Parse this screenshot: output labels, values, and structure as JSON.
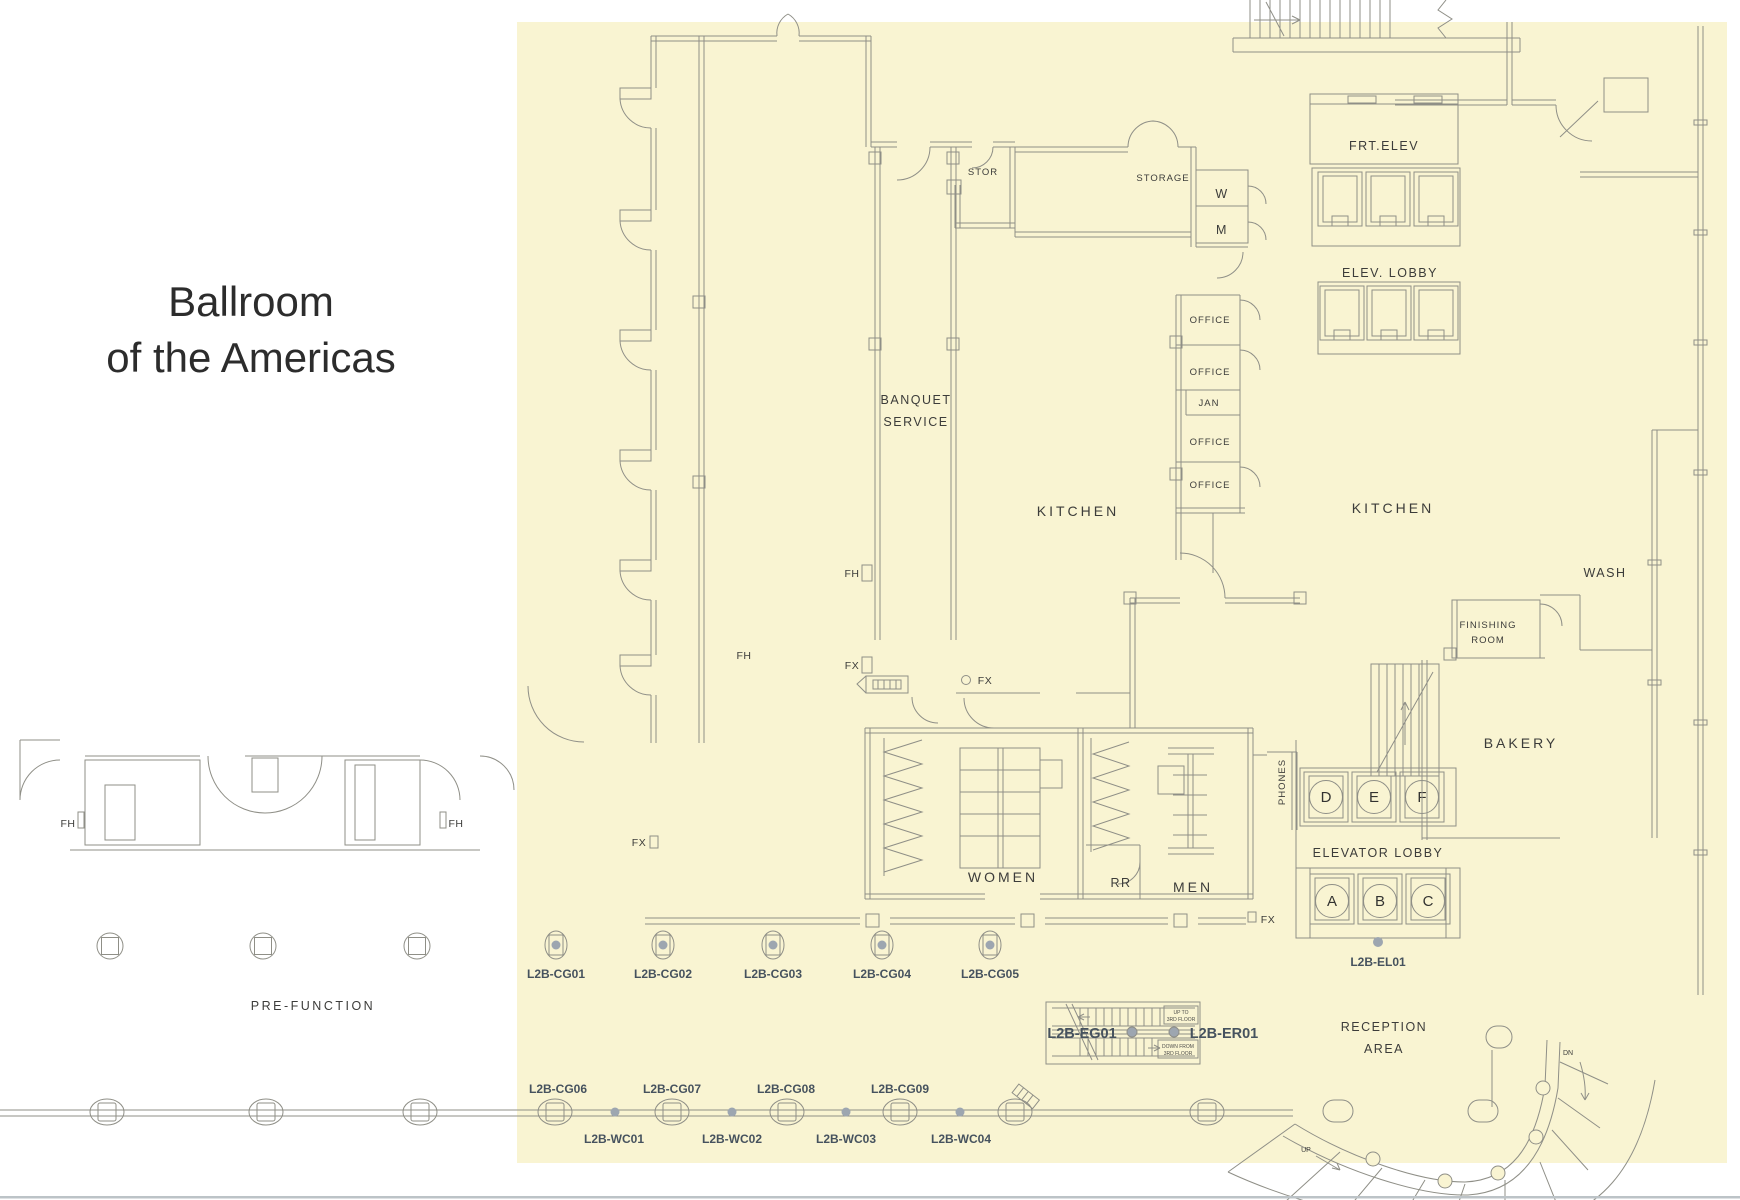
{
  "title": {
    "line1": "Ballroom",
    "line2": "of the Americas"
  },
  "colors": {
    "highlight": "#f9f4d2",
    "line": "#8f8f87",
    "room_label": "#3c3c3a",
    "code_label": "#46525e",
    "device_dot": "#9da6b0",
    "title_text": "#2c2c2c",
    "bottom_rule": "#bcc3c7"
  },
  "rooms": {
    "pre_function": "PRE-FUNCTION",
    "banquet_line1": "BANQUET",
    "banquet_line2": "SERVICE",
    "kitchen_left": "KITCHEN",
    "kitchen_right": "KITCHEN",
    "wash": "WASH",
    "finishing_line1": "FINISHING",
    "finishing_line2": "ROOM",
    "bakery": "BAKERY",
    "stor": "STOR",
    "storage": "STORAGE",
    "w_room": "W",
    "m_room": "M",
    "offices": [
      "OFFICE",
      "OFFICE",
      "OFFICE",
      "OFFICE"
    ],
    "jan": "JAN",
    "phones": "PHONES",
    "women": "WOMEN",
    "restroom": "RR",
    "men": "MEN",
    "reception_line1": "RECEPTION",
    "reception_line2": "AREA"
  },
  "markers": {
    "fh": "FH",
    "fx": "FX"
  },
  "elevators": {
    "front": "FRT.ELEV",
    "upper_lobby": "ELEV. LOBBY",
    "lower_lobby": "ELEVATOR LOBBY",
    "cars_upper": [
      "D",
      "E",
      "F"
    ],
    "cars_lower": [
      "A",
      "B",
      "C"
    ],
    "bank_code": "L2B-EL01"
  },
  "floor_boxes": {
    "codes": [
      "L2B-CG01",
      "L2B-CG02",
      "L2B-CG03",
      "L2B-CG04",
      "L2B-CG05"
    ]
  },
  "wall_devices": {
    "cg_codes": [
      "L2B-CG06",
      "L2B-CG07",
      "L2B-CG08",
      "L2B-CG09"
    ],
    "wc_codes": [
      "L2B-WC01",
      "L2B-WC02",
      "L2B-WC03",
      "L2B-WC04"
    ]
  },
  "escalator": {
    "left_code": "L2B-EG01",
    "right_code": "L2B-ER01",
    "up_note_line1": "UP TO",
    "up_note_line2": "3RD FLOOR",
    "down_note_line1": "DOWN FROM",
    "down_note_line2": "3RD FLOOR"
  },
  "stairs": {
    "down": "DN",
    "up": "UP"
  }
}
